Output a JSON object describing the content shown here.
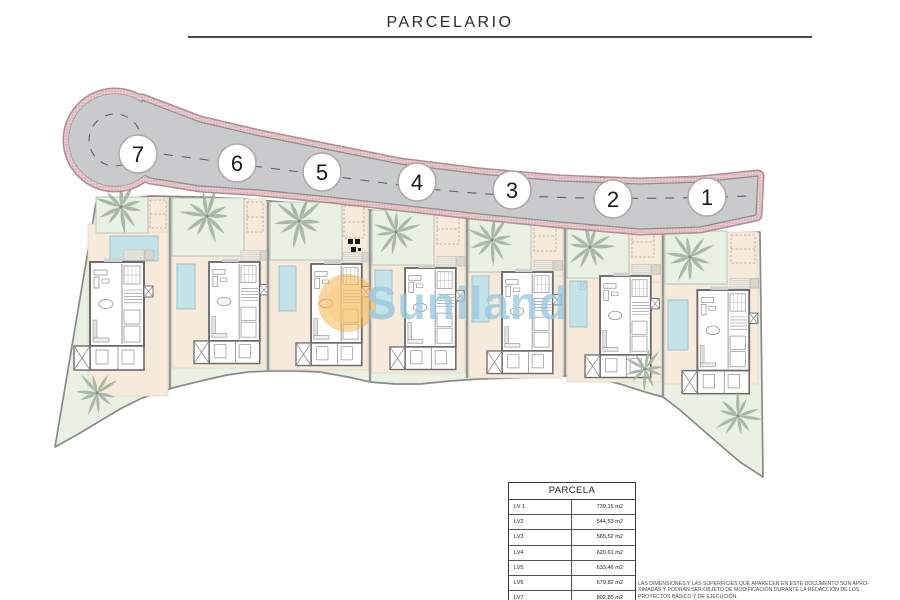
{
  "title": "PARCELARIO",
  "plan": {
    "markers": [
      {
        "label": "7",
        "x": 138,
        "y": 154
      },
      {
        "label": "6",
        "x": 237,
        "y": 163
      },
      {
        "label": "5",
        "x": 322,
        "y": 172
      },
      {
        "label": "4",
        "x": 417,
        "y": 182
      },
      {
        "label": "3",
        "x": 512,
        "y": 190
      },
      {
        "label": "2",
        "x": 613,
        "y": 199
      },
      {
        "label": "1",
        "x": 707,
        "y": 197
      }
    ],
    "colors": {
      "road": "#c8cacc",
      "road_edge": "#8c8c8c",
      "sidewalk": "#ecc9cd",
      "sidewalk_dot": "#c09298",
      "sidewalk_rim": "#a89094",
      "garden": "#e9f1e5",
      "terrace": "#f6ebdb",
      "pool": "#c3e3e9",
      "pool_edge": "#9fc3c9",
      "wall": "#6b6b6b",
      "palm": "#a3b1a0",
      "boundary": "#8a8a8a"
    }
  },
  "watermark": {
    "text": "Suniland",
    "reg": "®",
    "circle_color": "#f5ad42",
    "text_color": "#9cc8df"
  },
  "table": {
    "header": "PARCELA",
    "rows": [
      {
        "label": "LV 1",
        "value": "739,15 m2"
      },
      {
        "label": "LV2",
        "value": "544,53 m2"
      },
      {
        "label": "LV3",
        "value": "565,52 m2"
      },
      {
        "label": "LV4",
        "value": "620,61 m2"
      },
      {
        "label": "LV5",
        "value": "633,46 m2"
      },
      {
        "label": "LV6",
        "value": "679,82 m2"
      },
      {
        "label": "LV7",
        "value": "802,85 m2"
      }
    ]
  },
  "disclaimer": {
    "lines": [
      "LAS DIMENSIONES Y LAS SUPERFICIES QUE APARECEN EN ESTE DOCUMENTO SON APRO-",
      "XIMADAS Y PODRÁN SER OBJETO DE MODIFICACIÓN DURANTE LA REDACCIÓN DE LOS",
      "PROYECTOS BÁSICO Y DE EJECUCIÓN."
    ]
  }
}
